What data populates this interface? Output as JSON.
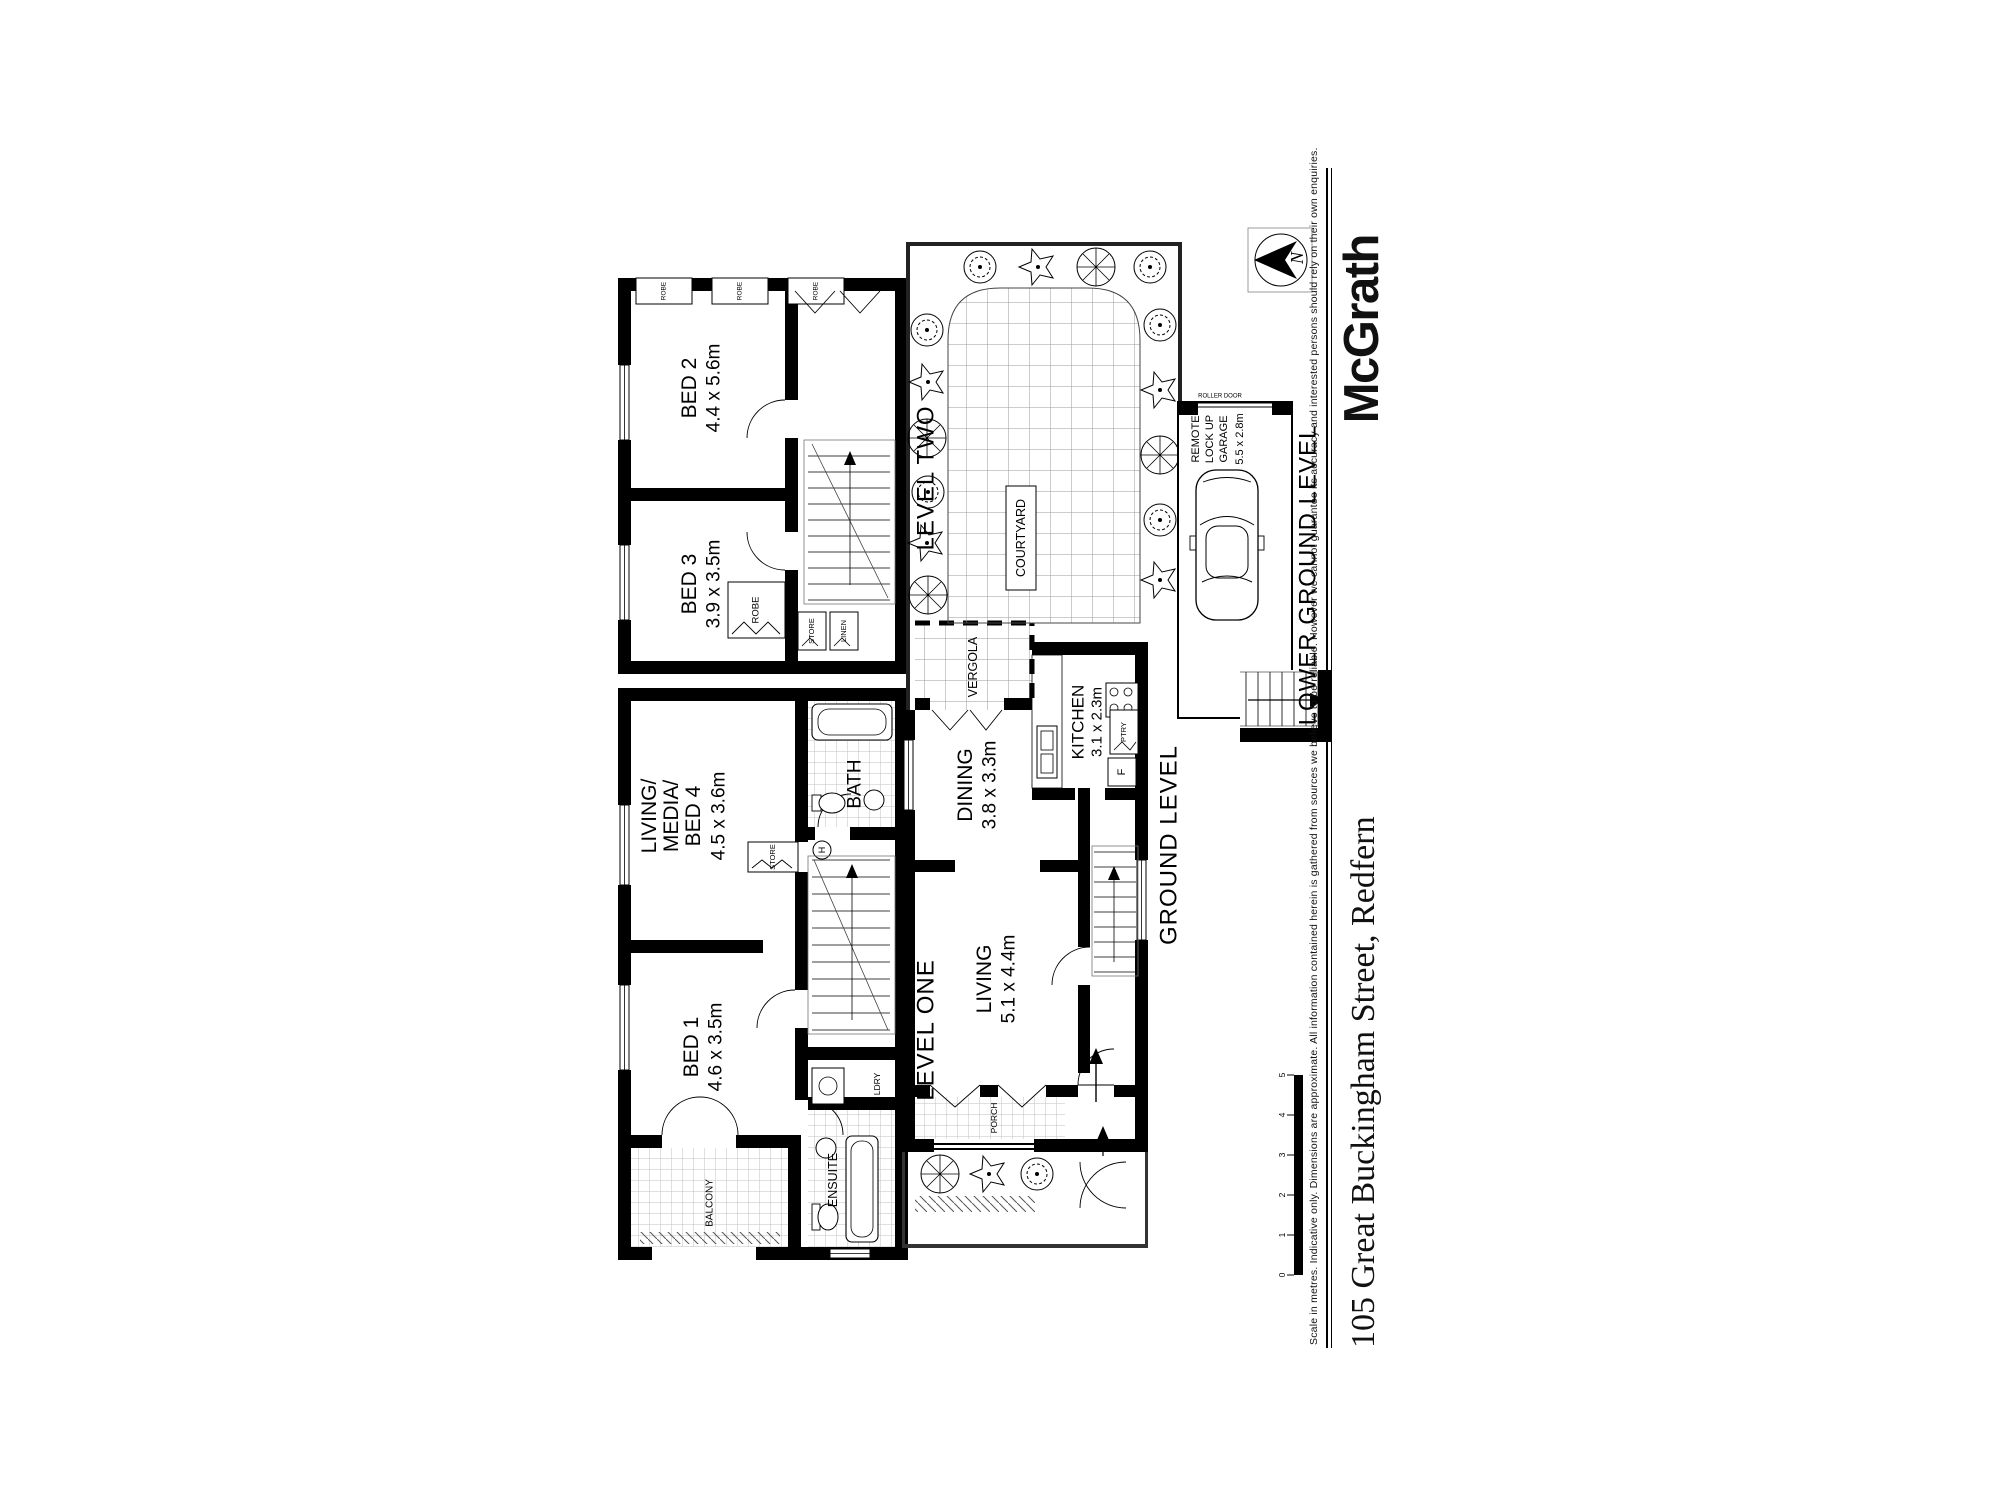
{
  "page": {
    "brand": "McGrath",
    "address": "105 Great Buckingham Street, Redfern",
    "disclaimer": "Scale in metres. Indicative only. Dimensions are approximate. All information contained herein is gathered from sources we believe to be reliable. However we cannot guarantee its accuracy and interested persons should rely on their own enquiries.",
    "north": "N"
  },
  "scale": {
    "n0": "0",
    "n1": "1",
    "n2": "2",
    "n3": "3",
    "n4": "4",
    "n5": "5"
  },
  "levels": {
    "one": "LEVEL ONE",
    "two": "LEVEL TWO",
    "ground": "GROUND LEVEL",
    "lower": "LOWER GROUND LEVEL"
  },
  "rooms": {
    "bed1": {
      "name": "BED 1",
      "dims": "4.6 x 3.5m"
    },
    "bed2": {
      "name": "BED 2",
      "dims": "4.4 x 5.6m"
    },
    "bed3": {
      "name": "BED 3",
      "dims": "3.9 x 3.5m"
    },
    "living_media": {
      "l1": "LIVING/",
      "l2": "MEDIA/",
      "l3": "BED 4",
      "dims": "4.5 x 3.6m"
    },
    "living": {
      "name": "LIVING",
      "dims": "5.1 x 4.4m"
    },
    "dining": {
      "name": "DINING",
      "dims": "3.8 x 3.3m"
    },
    "kitchen": {
      "name": "KITCHEN",
      "dims": "3.1 x 2.3m"
    },
    "garage": {
      "l1": "REMOTE",
      "l2": "LOCK UP",
      "l3": "GARAGE",
      "dims": "5.5 x 2.8m"
    },
    "courtyard": "COURTYARD",
    "vergola": "VERGOLA",
    "balcony": "BALCONY",
    "porch": "PORCH",
    "bath": "BATH",
    "ensuite": "ENSUITE",
    "ldry": "LDRY",
    "robe": "ROBE",
    "store": "STORE",
    "linen": "LINEN",
    "ptry": "PTRY",
    "fridge": "F",
    "hot_water": "H",
    "roller": "ROLLER DOOR"
  },
  "colors": {
    "ink": "#000000",
    "paper": "#ffffff"
  }
}
